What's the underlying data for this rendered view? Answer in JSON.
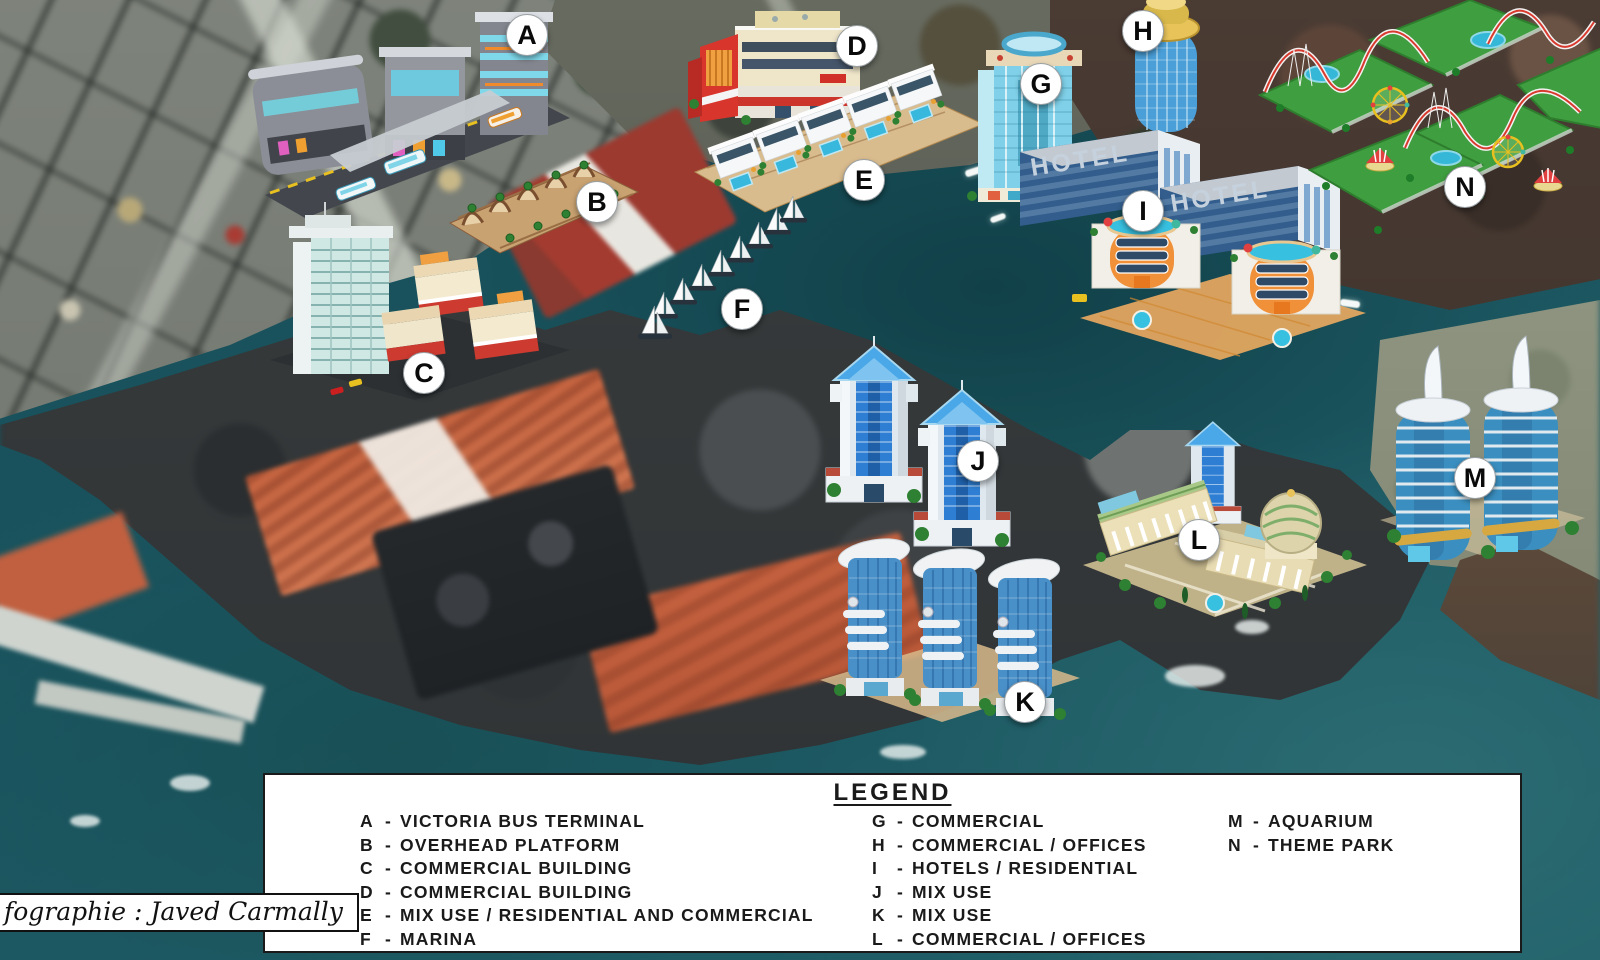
{
  "legend": {
    "title": "LEGEND",
    "separator": "-",
    "items": [
      {
        "letter": "A",
        "name": "VICTORIA BUS TERMINAL"
      },
      {
        "letter": "B",
        "name": "OVERHEAD PLATFORM"
      },
      {
        "letter": "C",
        "name": "COMMERCIAL BUILDING"
      },
      {
        "letter": "D",
        "name": "COMMERCIAL BUILDING"
      },
      {
        "letter": "E",
        "name": "MIX USE / RESIDENTIAL AND COMMERCIAL"
      },
      {
        "letter": "F",
        "name": "MARINA"
      },
      {
        "letter": "G",
        "name": "COMMERCIAL"
      },
      {
        "letter": "H",
        "name": "COMMERCIAL / OFFICES"
      },
      {
        "letter": "I",
        "name": "HOTELS / RESIDENTIAL"
      },
      {
        "letter": "J",
        "name": "MIX USE"
      },
      {
        "letter": "K",
        "name": "MIX USE"
      },
      {
        "letter": "L",
        "name": "COMMERCIAL / OFFICES"
      },
      {
        "letter": "M",
        "name": "AQUARIUM"
      },
      {
        "letter": "N",
        "name": "THEME PARK"
      }
    ]
  },
  "markers": [
    {
      "letter": "A"
    },
    {
      "letter": "B"
    },
    {
      "letter": "C"
    },
    {
      "letter": "D"
    },
    {
      "letter": "E"
    },
    {
      "letter": "F"
    },
    {
      "letter": "G"
    },
    {
      "letter": "H"
    },
    {
      "letter": "I"
    },
    {
      "letter": "J"
    },
    {
      "letter": "K"
    },
    {
      "letter": "L"
    },
    {
      "letter": "M"
    },
    {
      "letter": "N"
    }
  ],
  "buildings": {
    "hotel_sign_left": "HOTEL",
    "hotel_sign_right": "HOTEL"
  },
  "attribution": {
    "text": "fographie : Javed Carmally"
  },
  "palette": {
    "water": "#1a545e",
    "city_gray": "#7e837b",
    "land_dark": "#35393a",
    "terrain_brown": "#4a3b33",
    "warehouse_orange": "#c4633f",
    "marker_bg": "#ffffff",
    "marker_text": "#0a0a0a",
    "legend_bg": "#ffffff",
    "legend_text": "#1a1a1a",
    "accent_red": "#d8352c",
    "accent_orange": "#f0913a",
    "accent_cyan": "#7fd0e8",
    "accent_blue": "#2e7fd4",
    "theme_green": "#3f9e3f",
    "gold": "#e8c35a"
  }
}
